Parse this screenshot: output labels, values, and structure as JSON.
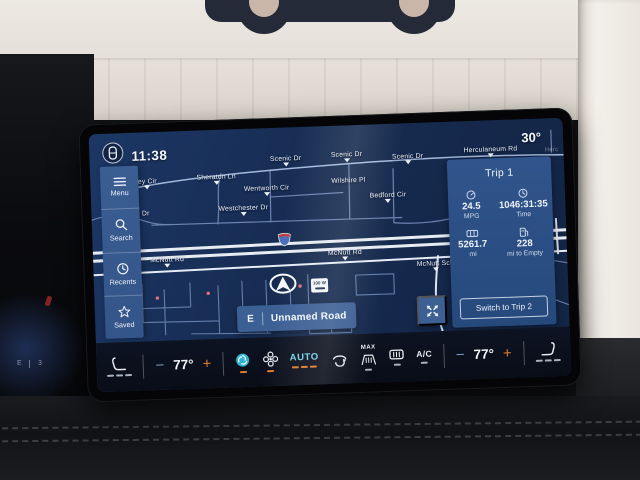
{
  "status": {
    "time": "11:38",
    "outside_temp": "30°"
  },
  "sidebar": {
    "items": [
      {
        "label": "Menu"
      },
      {
        "label": "Search"
      },
      {
        "label": "Recents"
      },
      {
        "label": "Saved"
      }
    ]
  },
  "map": {
    "labels": [
      {
        "text": "ey Cir"
      },
      {
        "text": "r Dr"
      },
      {
        "text": "Sheraton Ln"
      },
      {
        "text": "Wentworth Cir"
      },
      {
        "text": "Scenic Dr"
      },
      {
        "text": "Scenic Dr"
      },
      {
        "text": "Scenic Dr"
      },
      {
        "text": "Wilshire Pl"
      },
      {
        "text": "Bedford Cir"
      },
      {
        "text": "Westchester Dr"
      },
      {
        "text": "Herculaneum Rd"
      },
      {
        "text": "McNutt Rd"
      },
      {
        "text": "McNutt Rd"
      },
      {
        "text": "McNutt Sch"
      },
      {
        "text": "Herc"
      }
    ],
    "sign_text": "100 W",
    "banner": {
      "direction": "E",
      "road": "Unnamed Road"
    }
  },
  "trip": {
    "title": "Trip 1",
    "stats": [
      {
        "value": "24.5",
        "label": "MPG"
      },
      {
        "value": "1046:31:35",
        "label": "Time"
      },
      {
        "value": "5261.7",
        "label": "mi"
      },
      {
        "value": "228",
        "label": "mi to Empty"
      }
    ],
    "switch_label": "Switch to Trip 2"
  },
  "climate": {
    "minus": "−",
    "plus": "+",
    "driver_temp": "77°",
    "passenger_temp": "77°",
    "auto_label": "AUTO",
    "max_label": "MAX",
    "ac_label": "A/C"
  },
  "cluster": {
    "fuel": "E",
    "gear": "3"
  },
  "colors": {
    "accent_orange": "#e07b2a",
    "accent_cyan": "#74d3e8",
    "map_blue": "#16294e",
    "panel_blue": "#2e5288"
  }
}
